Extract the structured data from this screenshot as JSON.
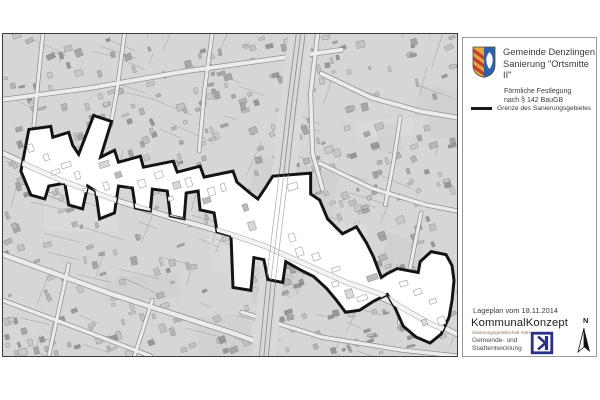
{
  "panel": {
    "title_line1": "Gemeinde Denzlingen",
    "title_line2": "Sanierung \"Ortsmitte II\"",
    "subtitle_line1": "Förmliche Festlegung",
    "subtitle_line2": "nach § 142 BauGB",
    "legend_label": "Grenze des Sanierungsgebietes",
    "date_label": "Lageplan vom 18.11.2014",
    "company_name": "KommunalKonzept",
    "company_subtitle": "Sanierungsgesellschaft mbH",
    "company_desc_line1": "Gemeinde- und",
    "company_desc_line2": "Stadtentwicklung",
    "north_label": "N"
  },
  "map": {
    "kind": "cadastral site plan (Lageplan)",
    "highlight_area": "Sanierungsgebiet \"Ortsmitte II\"",
    "boundary_color": "#141414",
    "background_color": "#d6d6d6",
    "highlight_fill": "#ffffff",
    "road_fill": "#ececec",
    "road_casing": "#8f8f8f",
    "railway_color": "#8a8a8a"
  },
  "colors": {
    "crest_gold": "#e3a73c",
    "crest_red": "#c63c30",
    "crest_blue": "#2e62a8",
    "logo_blue": "#2b3088"
  }
}
